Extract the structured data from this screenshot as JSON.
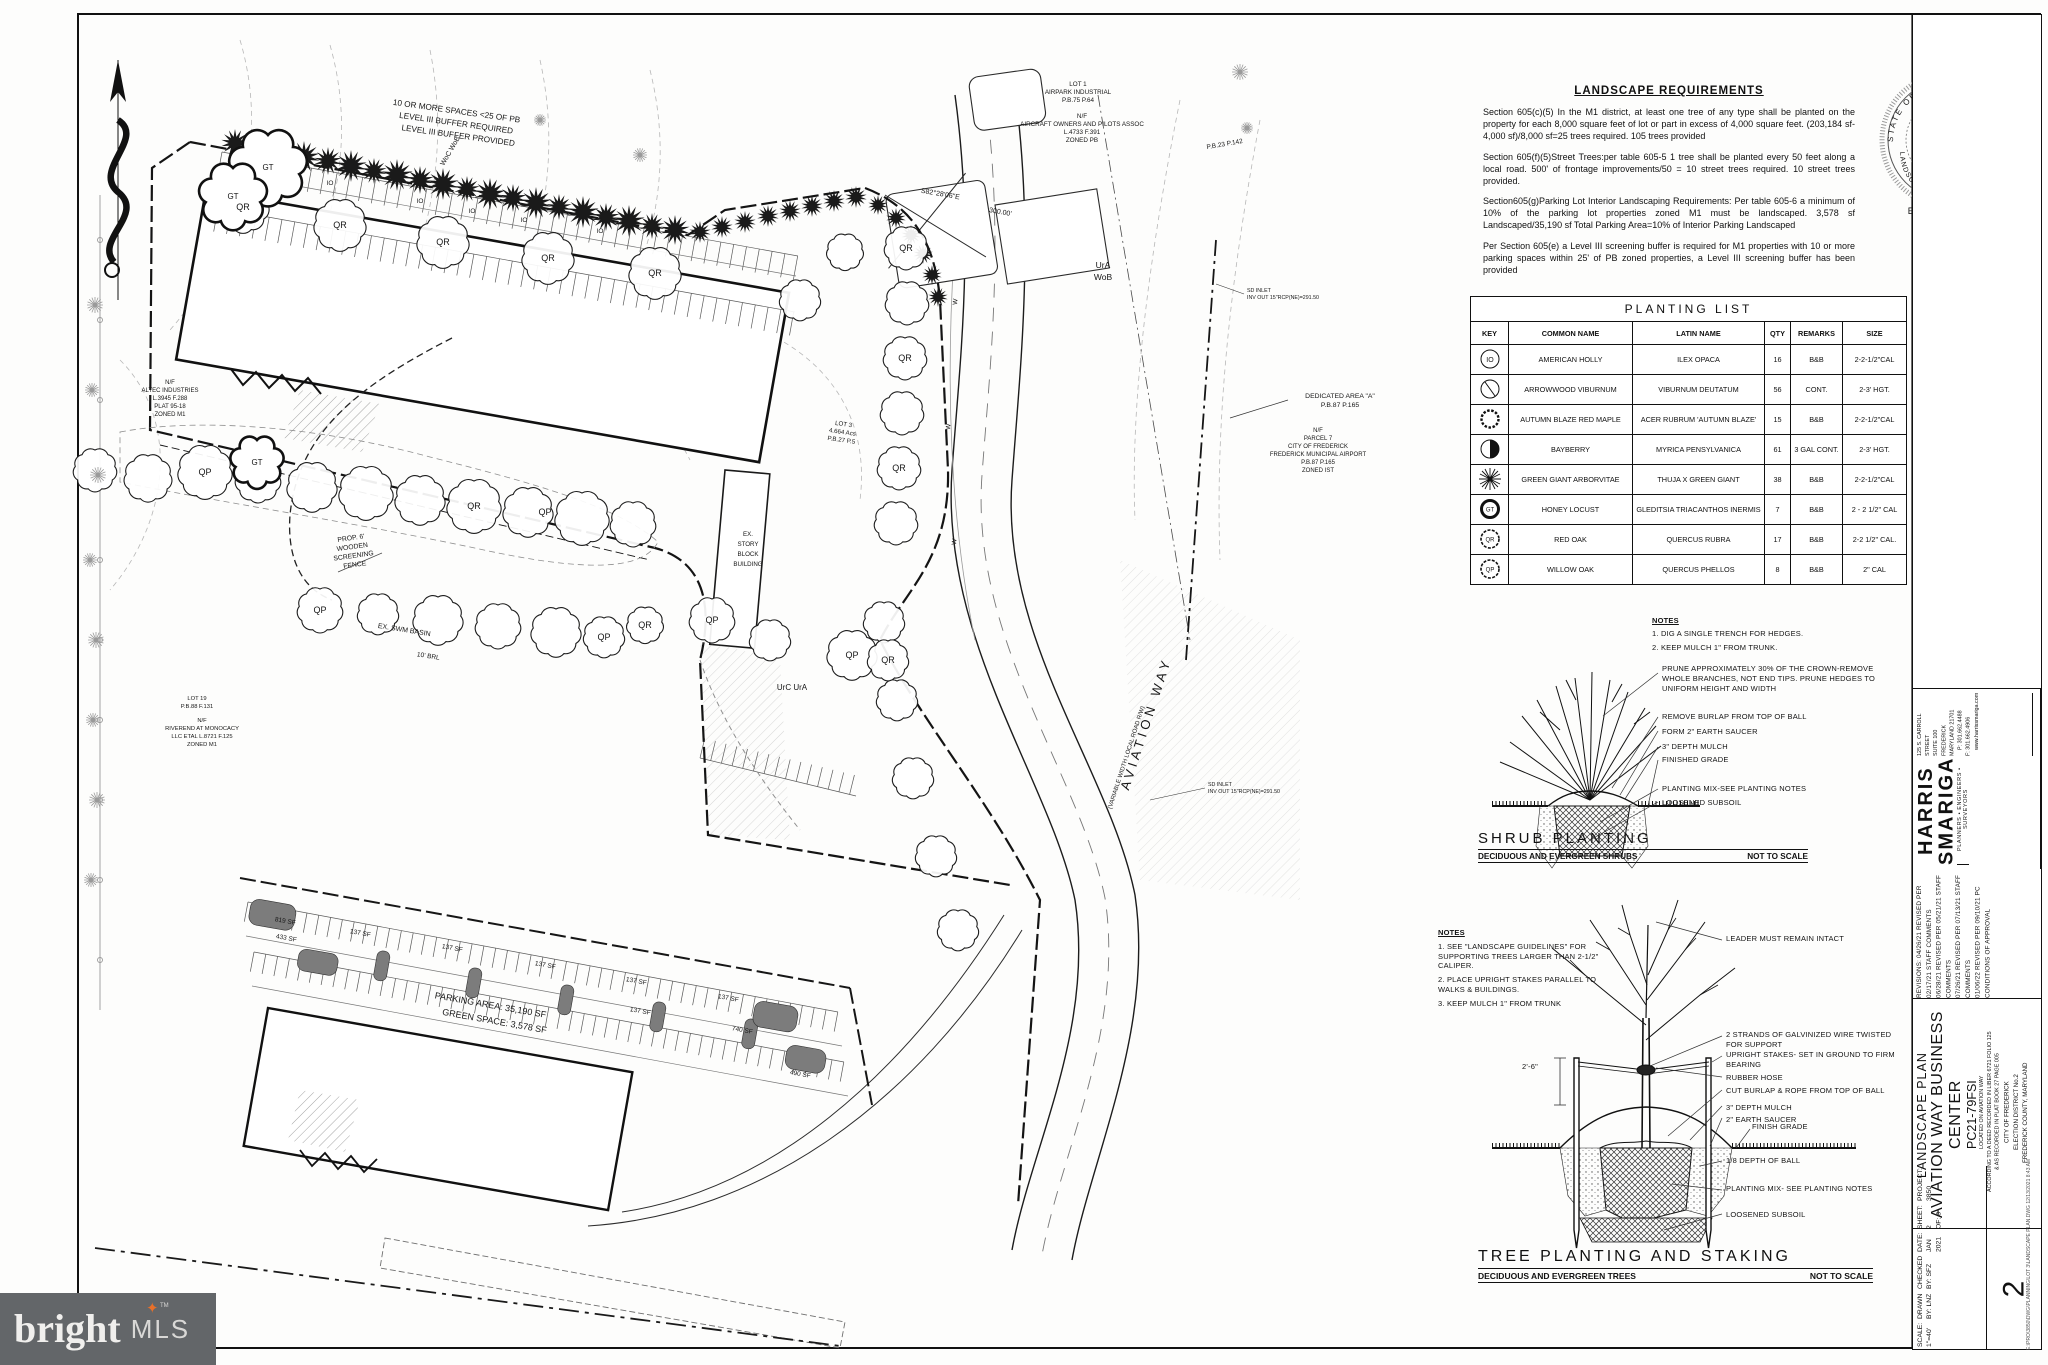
{
  "requirements": {
    "title": "LANDSCAPE REQUIREMENTS",
    "p1": "Section 605(c)(5) In the M1 district, at least one tree of any type shall be planted on the property for each 8,000 square feet of lot or part in excess of 4,000 square feet. (203,184 sf-4,000 sf)/8,000 sf=25 trees required. 105 trees provided",
    "p2": "Section 605(f)(5)Street Trees:per table 605-5 1 tree shall be planted every 50 feet along a local road. 500' of frontage improvements/50 = 10 street trees required. 10 street trees provided.",
    "p3": "Section605(g)Parking Lot Interior Landscaping Requirements: Per table 605-6 a minimum of 10% of the parking lot properties zoned M1 must be landscaped. 3,578 sf Landscaped/35,190 sf Total Parking Area=10% of Interior Parking Landscaped",
    "p4": "Per Section 605(e) a Level III screening buffer is required for M1 properties with 10 or more parking spaces within 25' of PB zoned properties, a Level III screening buffer has been provided"
  },
  "planting_list": {
    "title": "PLANTING LIST",
    "headers": [
      "KEY",
      "COMMON NAME",
      "LATIN NAME",
      "QTY",
      "REMARKS",
      "SIZE"
    ],
    "rows": [
      {
        "key": "IO",
        "common": "AMERICAN HOLLY",
        "latin": "ILEX OPACA",
        "qty": "16",
        "remarks": "B&B",
        "size": "2-2-1/2\"CAL"
      },
      {
        "key": "",
        "common": "ARROWWOOD VIBURNUM",
        "latin": "VIBURNUM DEUTATUM",
        "qty": "56",
        "remarks": "CONT.",
        "size": "2-3' HGT."
      },
      {
        "key": "",
        "common": "AUTUMN BLAZE RED MAPLE",
        "latin": "ACER RUBRUM 'AUTUMN BLAZE'",
        "qty": "15",
        "remarks": "B&B",
        "size": "2-2-1/2\"CAL"
      },
      {
        "key": "",
        "common": "BAYBERRY",
        "latin": "MYRICA PENSYLVANICA",
        "qty": "61",
        "remarks": "3 GAL CONT.",
        "size": "2-3' HGT."
      },
      {
        "key": "",
        "common": "GREEN GIANT ARBORVITAE",
        "latin": "THUJA X GREEN GIANT",
        "qty": "38",
        "remarks": "B&B",
        "size": "2-2-1/2\"CAL"
      },
      {
        "key": "GT",
        "common": "HONEY LOCUST",
        "latin": "GLEDITSIA TRIACANTHOS INERMIS",
        "qty": "7",
        "remarks": "B&B",
        "size": "2 - 2 1/2\" CAL"
      },
      {
        "key": "QR",
        "common": "RED OAK",
        "latin": "QUERCUS RUBRA",
        "qty": "17",
        "remarks": "B&B",
        "size": "2-2 1/2\" CAL."
      },
      {
        "key": "QP",
        "common": "WILLOW OAK",
        "latin": "QUERCUS PHELLOS",
        "qty": "8",
        "remarks": "B&B",
        "size": "2\" CAL"
      }
    ]
  },
  "shrub_detail": {
    "notes_title": "NOTES",
    "note1": "1.  DIG A SINGLE TRENCH FOR HEDGES.",
    "note2": "2.  KEEP MULCH 1\" FROM TRUNK.",
    "callouts": [
      "PRUNE APPROXIMATELY 30% OF THE CROWN-REMOVE WHOLE BRANCHES, NOT END TIPS. PRUNE HEDGES TO UNIFORM HEIGHT AND WIDTH",
      "REMOVE BURLAP FROM TOP OF BALL",
      "FORM 2\" EARTH SAUCER",
      "3\" DEPTH MULCH",
      "FINISHED GRADE",
      "PLANTING MIX-SEE PLANTING NOTES",
      "LOOSENED SUBSOIL"
    ],
    "title": "SHRUB PLANTING",
    "subtitle": "DECIDUOUS AND EVERGREEN SHRUBS",
    "scale_note": "NOT TO SCALE"
  },
  "tree_detail": {
    "notes_title": "NOTES",
    "note1": "1.   SEE \"LANDSCAPE GUIDELINES\" FOR SUPPORTING TREES LARGER THAN 2-1/2\" CALIPER.",
    "note2": "2.   PLACE UPRIGHT STAKES PARALLEL TO WALKS & BUILDINGS.",
    "note3": "3.   KEEP MULCH 1\" FROM TRUNK",
    "dimension": "2'-6\"",
    "callouts": [
      "LEADER MUST REMAIN INTACT",
      "2 STRANDS OF GALVINIZED WIRE TWISTED FOR SUPPORT",
      "UPRIGHT STAKES- SET IN GROUND TO FIRM BEARING",
      "RUBBER HOSE",
      "CUT BURLAP & ROPE FROM TOP OF BALL",
      "3\" DEPTH MULCH",
      "2\" EARTH SAUCER",
      "FINISH GRADE",
      "1/8 DEPTH OF BALL",
      "PLANTING MIX- SEE PLANTING NOTES",
      "LOOSENED SUBSOIL"
    ],
    "title": "TREE PLANTING AND STAKING",
    "subtitle": "DECIDUOUS AND EVERGREEN TREES",
    "scale_note": "NOT TO SCALE"
  },
  "title_block": {
    "firm1": "HARRIS",
    "firm2": "SMARIGA",
    "tagline": "PLANNERS • ENGINEERS • SURVEYORS",
    "address": [
      "125 S. CARROLL STREET",
      "SUITE 100",
      "FREDERICK",
      "MARYLAND 21701"
    ],
    "phone": "P: 301.662.4488",
    "fax": "F: 301.662.4906",
    "web": "www.harrissmariga.com",
    "revisions": [
      "REVISIONS: 04/26/21 REVISED PER 02/17/21 STAFF COMMENTS",
      "06/28/21 REVISED PER 05/21/21 STAFF COMMENTS",
      "07/26/21 REVISED PER 07/13/21 STAFF COMMENTS",
      "01/06/22 REVISED PER 09/10/21 PC CONDITIONS OF APPROVAL"
    ],
    "sheet_type": "LANDSCAPE PLAN",
    "project_name1": "AVIATION WAY BUSINESS",
    "project_name2": "CENTER",
    "project_code": "PC21-79FSI",
    "location": [
      "LOCATED ON AVIATION WAY",
      "ACCORDING TO A DEED RECORDED IN LIBER 6721 FOLIO 125",
      "& AS RECORDED IN PLAT BOOK 27 PAGE 005"
    ],
    "jurisdiction": [
      "CITY OF FREDERICK",
      "ELECTION DISTRICT No.2",
      "FREDERICK COUNTY, MARYLAND"
    ],
    "scale_label": "SCALE:",
    "scale": "1\"=40'",
    "drawn_label": "DRAWN",
    "drawn": "BY: LNZ",
    "checked_label": "CHECKED",
    "checked": "BY: SFZ",
    "date_label": "DATE:",
    "date": "JAN 2021",
    "sheet": "SHEET: 2",
    "sheet_of": "OF:  3",
    "project_label": "PROJECT:",
    "project_no": "3850",
    "big_number": "2",
    "file_note": "E:\\PRO\\3850\\DWG\\PLANNING\\LOT 3\\LANDSCAPE PLAN.DWG   12/13/2021 8:43 AM"
  },
  "seal": {
    "arc_top": "STATE OF MARYLAND",
    "arc_bottom": "LANDSCAPE ARCHITECT",
    "name": "Luke N. Zeller",
    "number": "3953",
    "expires": "EXPIRES 2-21-23"
  },
  "plan": {
    "buffer_note": [
      "10 OR MORE SPACES <25 OF PB",
      "LEVEL III BUFFER REQUIRED",
      "LEVEL III BUFFER PROVIDED"
    ],
    "lot1": [
      "LOT 1",
      "AIRPARK INDUSTRIAL",
      "P.B.75 P.64"
    ],
    "aopa": [
      "N/F",
      "AIRCRAFT OWNERS AND PILOTS ASSOC",
      "L.4733 F.391",
      "ZONED PB"
    ],
    "pb23": "P.B.23 P.142",
    "bearing": "S82°28'06\"E",
    "distance": "300.00'",
    "altec": [
      "N/F",
      "ALTEC INDUSTRIES",
      "L.3945 F.288",
      "PLAT 95-18",
      "ZONED M1"
    ],
    "fence": [
      "PROP. 6'",
      "WOODEN",
      "SCREENING",
      "FENCE"
    ],
    "lot3": [
      "LOT 3",
      "4.664 Acs",
      "P.B.27 P.5"
    ],
    "dedicated": [
      "DEDICATED AREA \"A\"",
      "P.B.87 P.165"
    ],
    "parcel7": [
      "N/F",
      "PARCEL 7",
      "CITY OF FREDERICK",
      "FREDERICK MUNICIPAL AIRPORT",
      "P.B.87 P.165",
      "ZONED IST"
    ],
    "lot19": [
      "LOT 19",
      "P.B.88 F.131"
    ],
    "riverend": [
      "N/F",
      "RIVEREND AT MONOCACY",
      "LLC ETAL L.8721 F.125",
      "ZONED M1"
    ],
    "swm_basin": "EX. SWM BASIN",
    "brl": "10' BRL",
    "ex_building": [
      "EX.",
      "STORY",
      "BLOCK",
      "BUILDING"
    ],
    "road": "AVIATION  WAY",
    "road_sub": "(VARIABLE WIDTH LOCAL ROAD R/W)",
    "sd_inlet": [
      "SD INLET",
      "INV OUT 15\"RCP(NE)=291.50"
    ],
    "soil_ura": "UrA",
    "soil_wob": "WoB",
    "soil_urc_ura": "UrC  UrA",
    "soil_woc_wob": "WoC WoB",
    "tree_qr": "QR",
    "tree_qp": "QP",
    "tree_gt": "GT",
    "tree_io": "IO",
    "water_w": "W"
  },
  "inset": {
    "area1": "PARKING AREA: 35,190 SF",
    "area2": "GREEN SPACE: 3,578 SF",
    "islands": [
      "819 SF",
      "433 SF",
      "137 SF",
      "137 SF",
      "137 SF",
      "137 SF",
      "137 SF",
      "137 SF",
      "740 SF",
      "490 SF"
    ]
  },
  "logo": {
    "brand": "bright",
    "tm": "TM",
    "suffix": "MLS"
  }
}
